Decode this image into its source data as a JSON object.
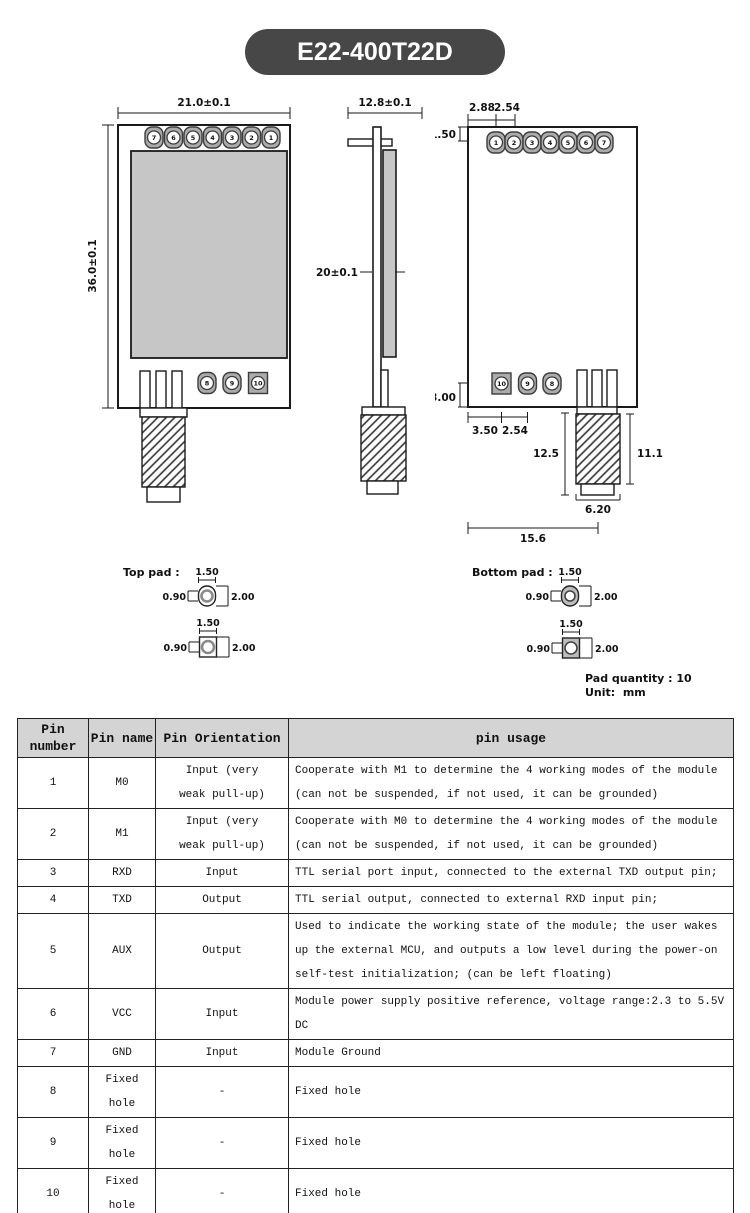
{
  "title": "E22-400T22D",
  "colors": {
    "pill_bg": "#474747",
    "pill_text": "#ffffff",
    "shield_gray": "#c6c6c6",
    "pad_gray": "#ababab",
    "table_header_bg": "#d4d4d4",
    "line": "#1a1a1a"
  },
  "front_view": {
    "width": "21.0±0.1",
    "height": "36.0±0.1",
    "pads_top": [
      "7",
      "6",
      "5",
      "4",
      "3",
      "2",
      "1"
    ],
    "pads_bottom": [
      "8",
      "9",
      "10"
    ]
  },
  "side_view": {
    "width": "12.8±0.1",
    "thickness": "4.20±0.1"
  },
  "back_view": {
    "pads_top": [
      "1",
      "2",
      "3",
      "4",
      "5",
      "6",
      "7"
    ],
    "pads_bottom": [
      "10",
      "9",
      "8"
    ],
    "dims": {
      "edge_to_pin1": "2.88",
      "pin_pitch": "2.54",
      "top_margin": "1.50",
      "bottom_margin": "3.00",
      "edge_to_pin10": "3.50",
      "bottom_pitch": "2.54",
      "connector_total": "12.5",
      "connector_body": "11.1",
      "connector_width": "6.20",
      "overall": "15.6"
    }
  },
  "pad_detail": {
    "top_label": "Top pad :",
    "bottom_label": "Bottom pad :",
    "width": "1.50",
    "hole": "0.90",
    "height": "2.00"
  },
  "notes": {
    "quantity": "Pad quantity : 10",
    "unit": "Unit:  mm"
  },
  "pin_table": {
    "headers": [
      "Pin number",
      "Pin name",
      "Pin Orientation",
      "pin usage"
    ],
    "rows": [
      {
        "number": "1",
        "name": "M0",
        "orientation": "Input (very weak pull-up)",
        "usage": "Cooperate with M1 to determine the 4 working modes of the module (can not be suspended, if not used, it can be grounded)"
      },
      {
        "number": "2",
        "name": "M1",
        "orientation": "Input (very weak pull-up)",
        "usage": "Cooperate with M0 to determine the 4 working modes of the module (can not be suspended, if not used, it can be grounded)"
      },
      {
        "number": "3",
        "name": "RXD",
        "orientation": "Input",
        "usage": "TTL serial port input, connected to the external TXD output pin;"
      },
      {
        "number": "4",
        "name": "TXD",
        "orientation": "Output",
        "usage": "TTL serial output, connected to external RXD input pin;"
      },
      {
        "number": "5",
        "name": "AUX",
        "orientation": "Output",
        "usage": "Used to indicate the working state of the module; the user wakes up the external MCU, and outputs a low level during the power-on self-test initialization; (can be left floating)"
      },
      {
        "number": "6",
        "name": "VCC",
        "orientation": "Input",
        "usage": "Module power supply positive reference, voltage range:2.3 to 5.5V DC"
      },
      {
        "number": "7",
        "name": "GND",
        "orientation": "Input",
        "usage": "Module Ground"
      },
      {
        "number": "8",
        "name": "Fixed hole",
        "orientation": "-",
        "usage": "Fixed hole"
      },
      {
        "number": "9",
        "name": "Fixed hole",
        "orientation": "-",
        "usage": "Fixed hole"
      },
      {
        "number": "10",
        "name": "Fixed hole",
        "orientation": "-",
        "usage": "Fixed hole"
      }
    ]
  }
}
